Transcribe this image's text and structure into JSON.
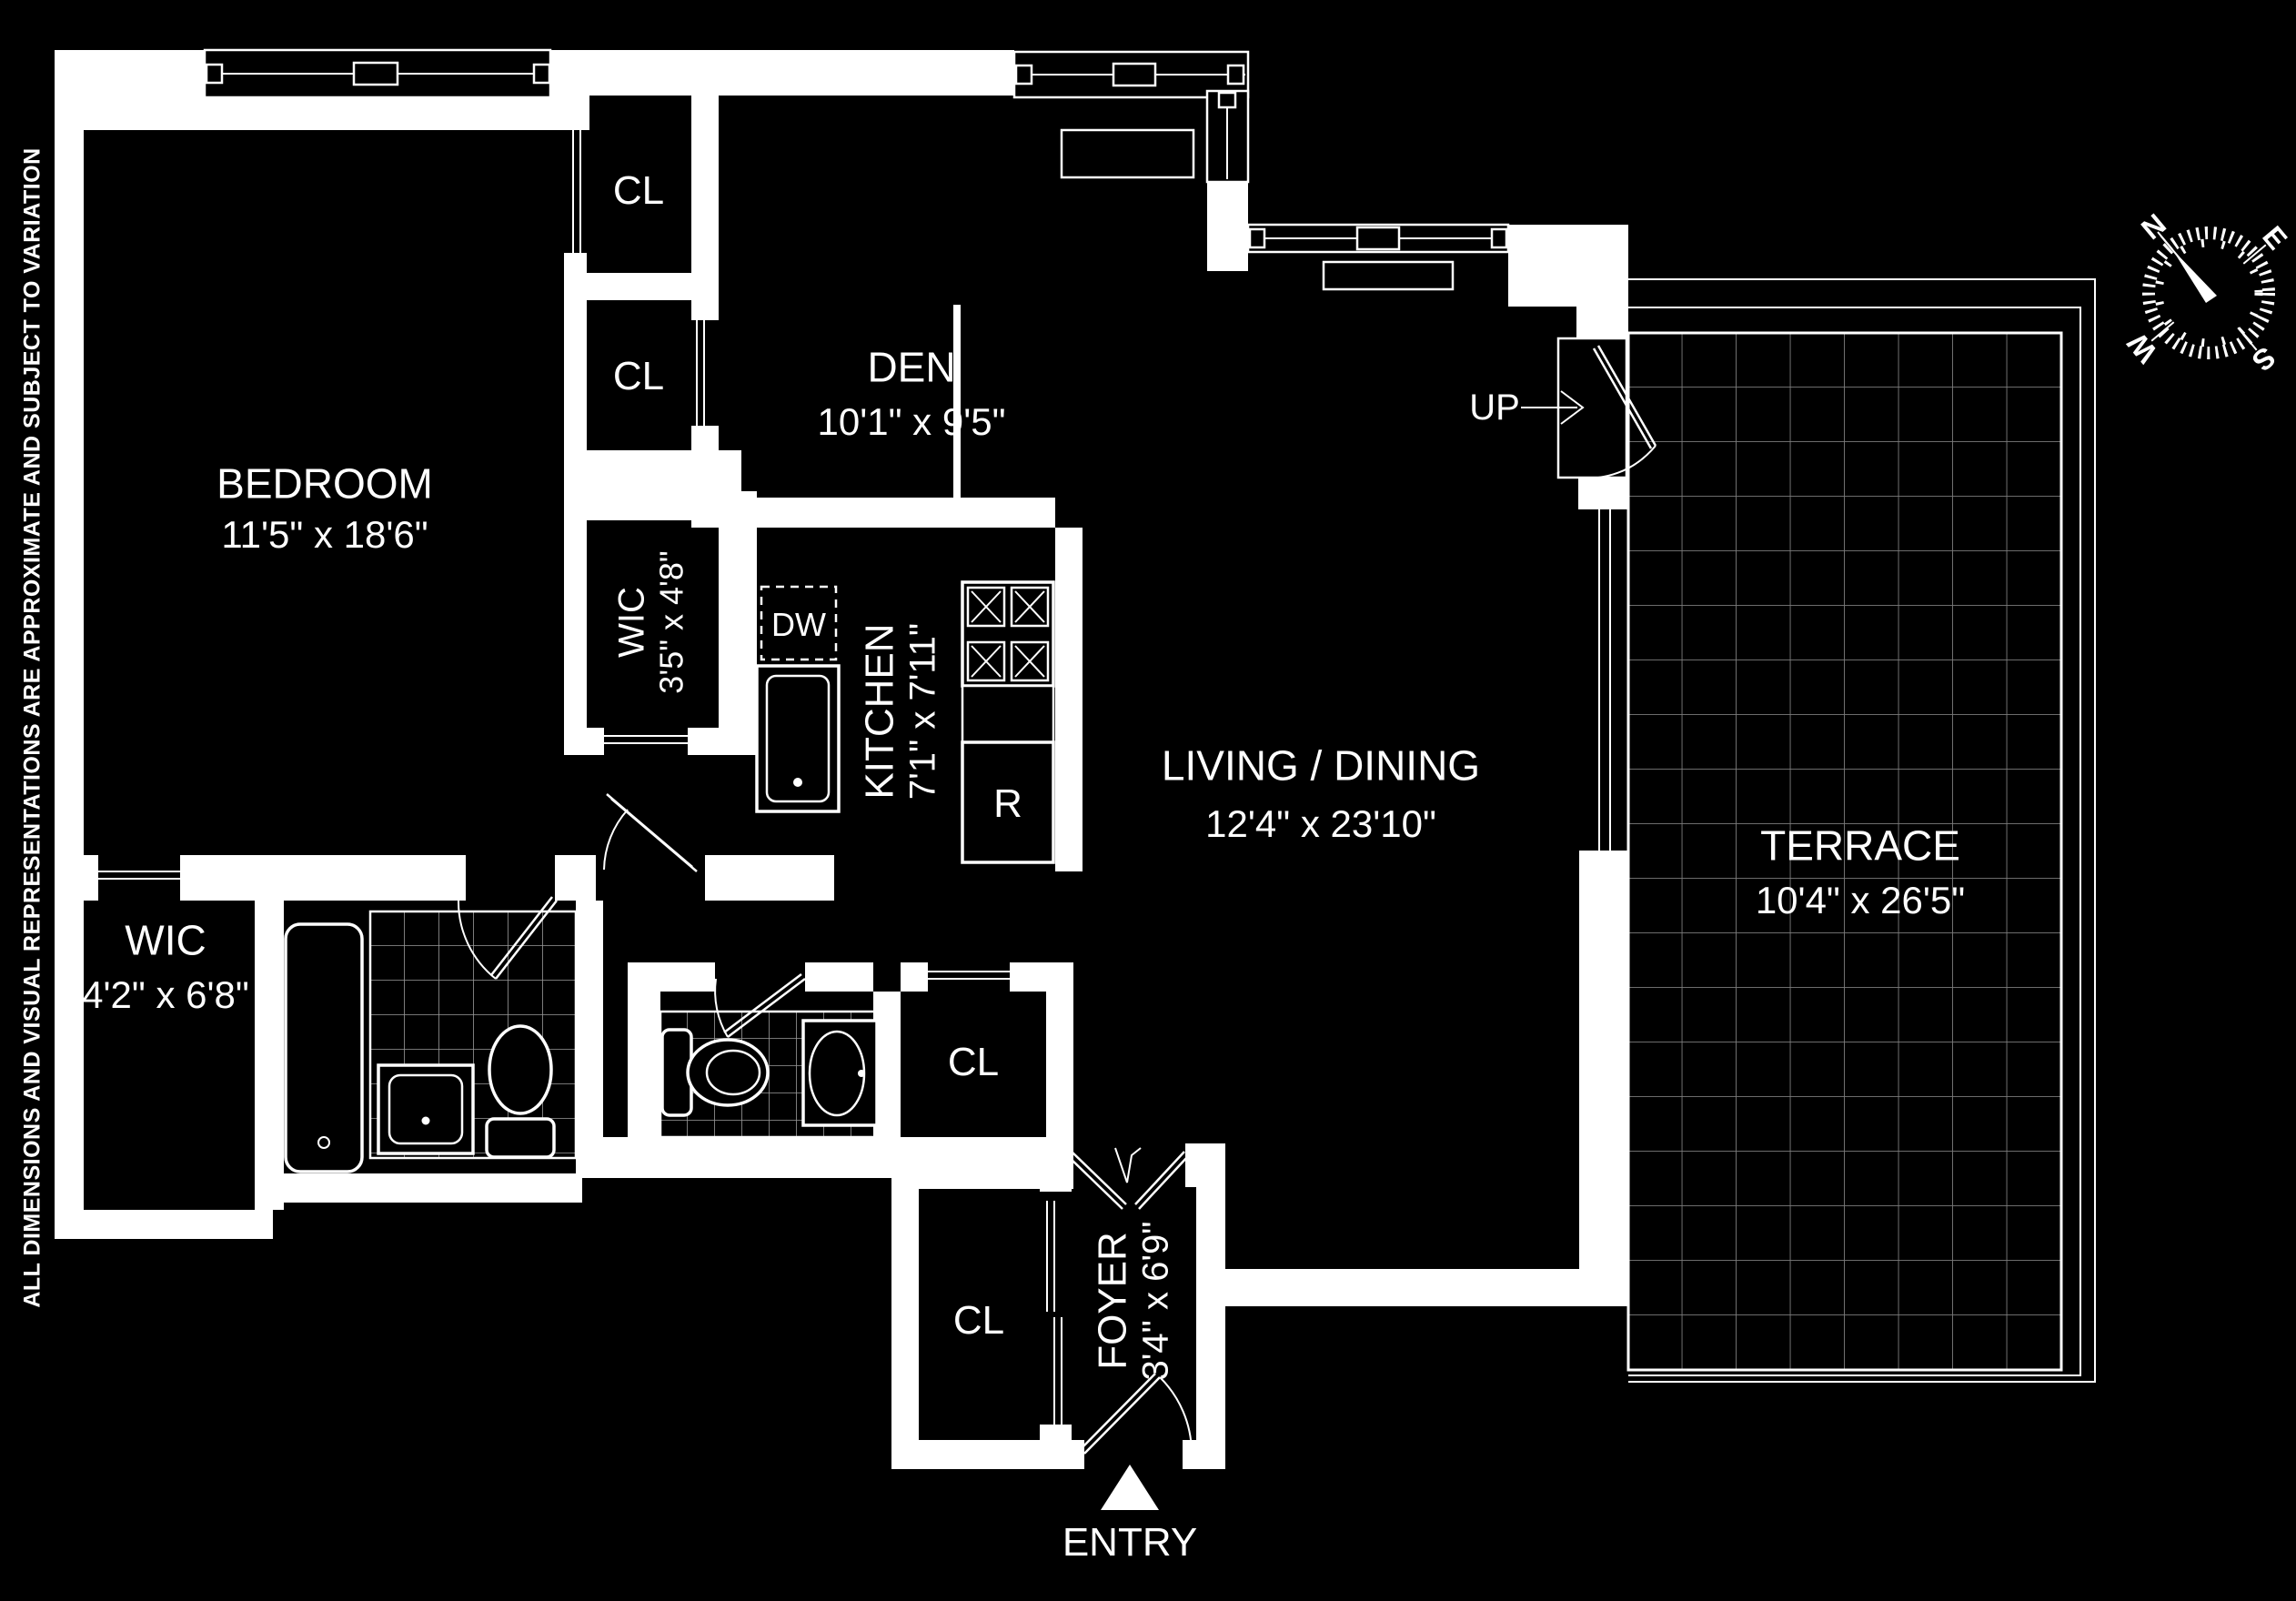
{
  "disclaimer": "ALL DIMENSIONS AND VISUAL REPRESENTATIONS ARE APPROXIMATE AND SUBJECT TO VARIATION",
  "rooms": {
    "bedroom": {
      "name": "BEDROOM",
      "dims": "11'5\" x 18'6\""
    },
    "den": {
      "name": "DEN",
      "dims": "10'1\" x 9'5\""
    },
    "wic_small": {
      "name": "WIC",
      "dims": "3'5\" x 4'8\""
    },
    "kitchen": {
      "name": "KITCHEN",
      "dims": "7'1\" x 7'11\""
    },
    "living": {
      "name": "LIVING / DINING",
      "dims": "12'4\" x 23'10\""
    },
    "terrace": {
      "name": "TERRACE",
      "dims": "10'4\" x 26'5\""
    },
    "wic_large": {
      "name": "WIC",
      "dims": "4'2\" x 6'8\""
    },
    "foyer": {
      "name": "FOYER",
      "dims": "3'4\" x 6'9\""
    }
  },
  "labels": {
    "closet": "CL",
    "dishwasher": "DW",
    "refrigerator": "R",
    "up": "UP",
    "entry": "ENTRY"
  },
  "compass": {
    "n": "N",
    "e": "E",
    "s": "S",
    "w": "W"
  },
  "colors": {
    "background": "#000000",
    "walls": "#ffffff",
    "terrace_grid": "#7c7c7c",
    "bath_grid": "#9a9a9a"
  }
}
